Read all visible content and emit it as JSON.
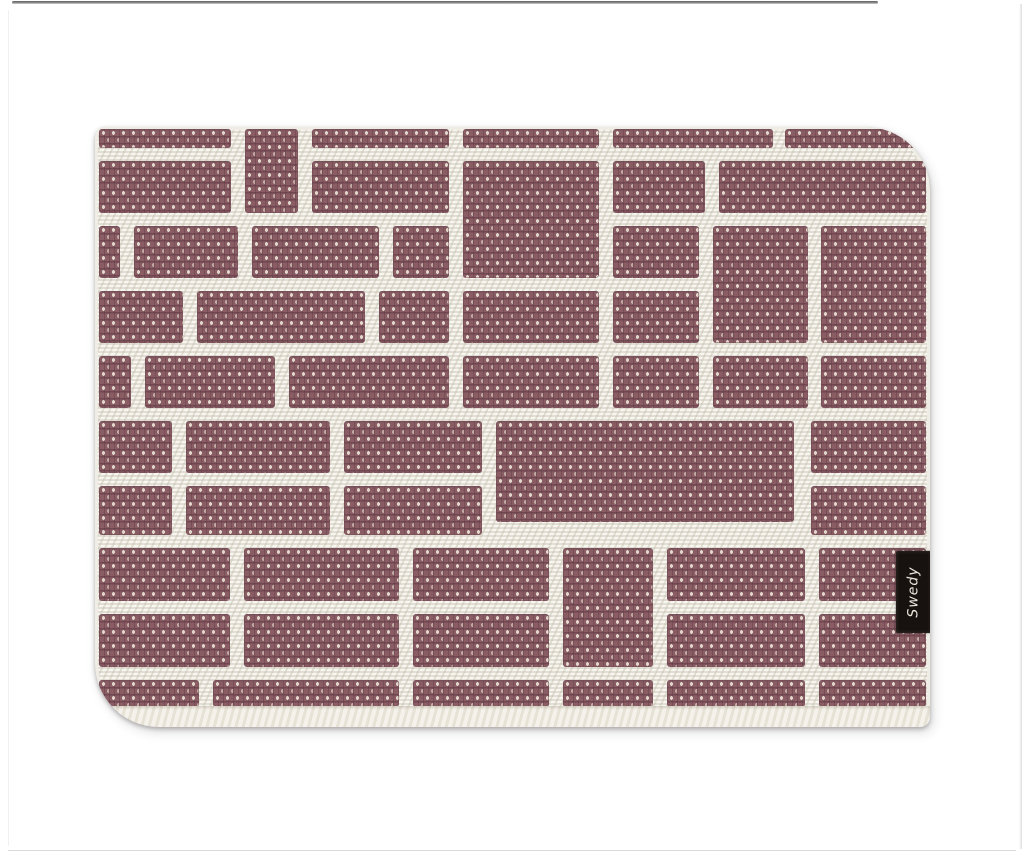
{
  "page": {
    "background": "#ffffff",
    "frame": {
      "top_line_color": "#6e6e6e",
      "side_line_color": "#dedede"
    }
  },
  "product_photo": {
    "description": "Swedy woven plastic placemat, brick weave pattern, plum and cream",
    "brand_tag": {
      "text": "Swedy",
      "background": "#17120f",
      "text_color": "#e9e5db",
      "x": 801,
      "y": 424,
      "width": 35,
      "height": 82
    },
    "mat": {
      "x": 95,
      "y": 127,
      "width": 835,
      "height": 600,
      "corner_radius": {
        "top_left": 10,
        "top_right": 64,
        "bottom_right": 10,
        "bottom_left": 64
      },
      "colors": {
        "brick": "#8a5c64",
        "brick_weft_shadow": "#5e3a42",
        "brick_stitch_light": "#dcd2c6",
        "ground": "#edeae1",
        "ground_shadow": "#c9c4b6"
      },
      "pattern": {
        "type": "brick-weave",
        "channel_width": 13,
        "bricks": [
          [
            4,
            2,
            132,
            19
          ],
          [
            217,
            2,
            137,
            19
          ],
          [
            368,
            2,
            136,
            19
          ],
          [
            518,
            2,
            160,
            19
          ],
          [
            690,
            2,
            141,
            19
          ],
          [
            150,
            2,
            53,
            84
          ],
          [
            4,
            34,
            132,
            52
          ],
          [
            217,
            34,
            137,
            52
          ],
          [
            518,
            34,
            92,
            52
          ],
          [
            624,
            34,
            207,
            52
          ],
          [
            368,
            34,
            136,
            117
          ],
          [
            4,
            99,
            21,
            52
          ],
          [
            39,
            99,
            104,
            52
          ],
          [
            157,
            99,
            127,
            52
          ],
          [
            298,
            99,
            56,
            52
          ],
          [
            518,
            99,
            86,
            52
          ],
          [
            618,
            99,
            95,
            117
          ],
          [
            726,
            99,
            105,
            117
          ],
          [
            4,
            164,
            84,
            52
          ],
          [
            102,
            164,
            168,
            52
          ],
          [
            284,
            164,
            70,
            52
          ],
          [
            368,
            164,
            136,
            52
          ],
          [
            518,
            164,
            86,
            52
          ],
          [
            4,
            229,
            32,
            52
          ],
          [
            50,
            229,
            130,
            52
          ],
          [
            194,
            229,
            160,
            52
          ],
          [
            368,
            229,
            136,
            52
          ],
          [
            518,
            229,
            86,
            52
          ],
          [
            618,
            229,
            95,
            52
          ],
          [
            726,
            229,
            105,
            52
          ],
          [
            4,
            294,
            73,
            52
          ],
          [
            91,
            294,
            144,
            52
          ],
          [
            249,
            294,
            138,
            52
          ],
          [
            716,
            294,
            115,
            52
          ],
          [
            401,
            294,
            298,
            101
          ],
          [
            4,
            359,
            73,
            49
          ],
          [
            91,
            359,
            144,
            49
          ],
          [
            249,
            359,
            138,
            49
          ],
          [
            716,
            359,
            115,
            49
          ],
          [
            4,
            421,
            131,
            53
          ],
          [
            149,
            421,
            155,
            53
          ],
          [
            318,
            421,
            136,
            53
          ],
          [
            572,
            421,
            138,
            53
          ],
          [
            724,
            421,
            107,
            53
          ],
          [
            468,
            421,
            90,
            119
          ],
          [
            4,
            487,
            131,
            53
          ],
          [
            149,
            487,
            155,
            53
          ],
          [
            318,
            487,
            136,
            53
          ],
          [
            572,
            487,
            138,
            53
          ],
          [
            724,
            487,
            107,
            53
          ],
          [
            4,
            553,
            100,
            27
          ],
          [
            118,
            553,
            186,
            27
          ],
          [
            318,
            553,
            136,
            27
          ],
          [
            468,
            553,
            90,
            27
          ],
          [
            572,
            553,
            138,
            27
          ],
          [
            724,
            553,
            107,
            27
          ]
        ]
      }
    }
  }
}
